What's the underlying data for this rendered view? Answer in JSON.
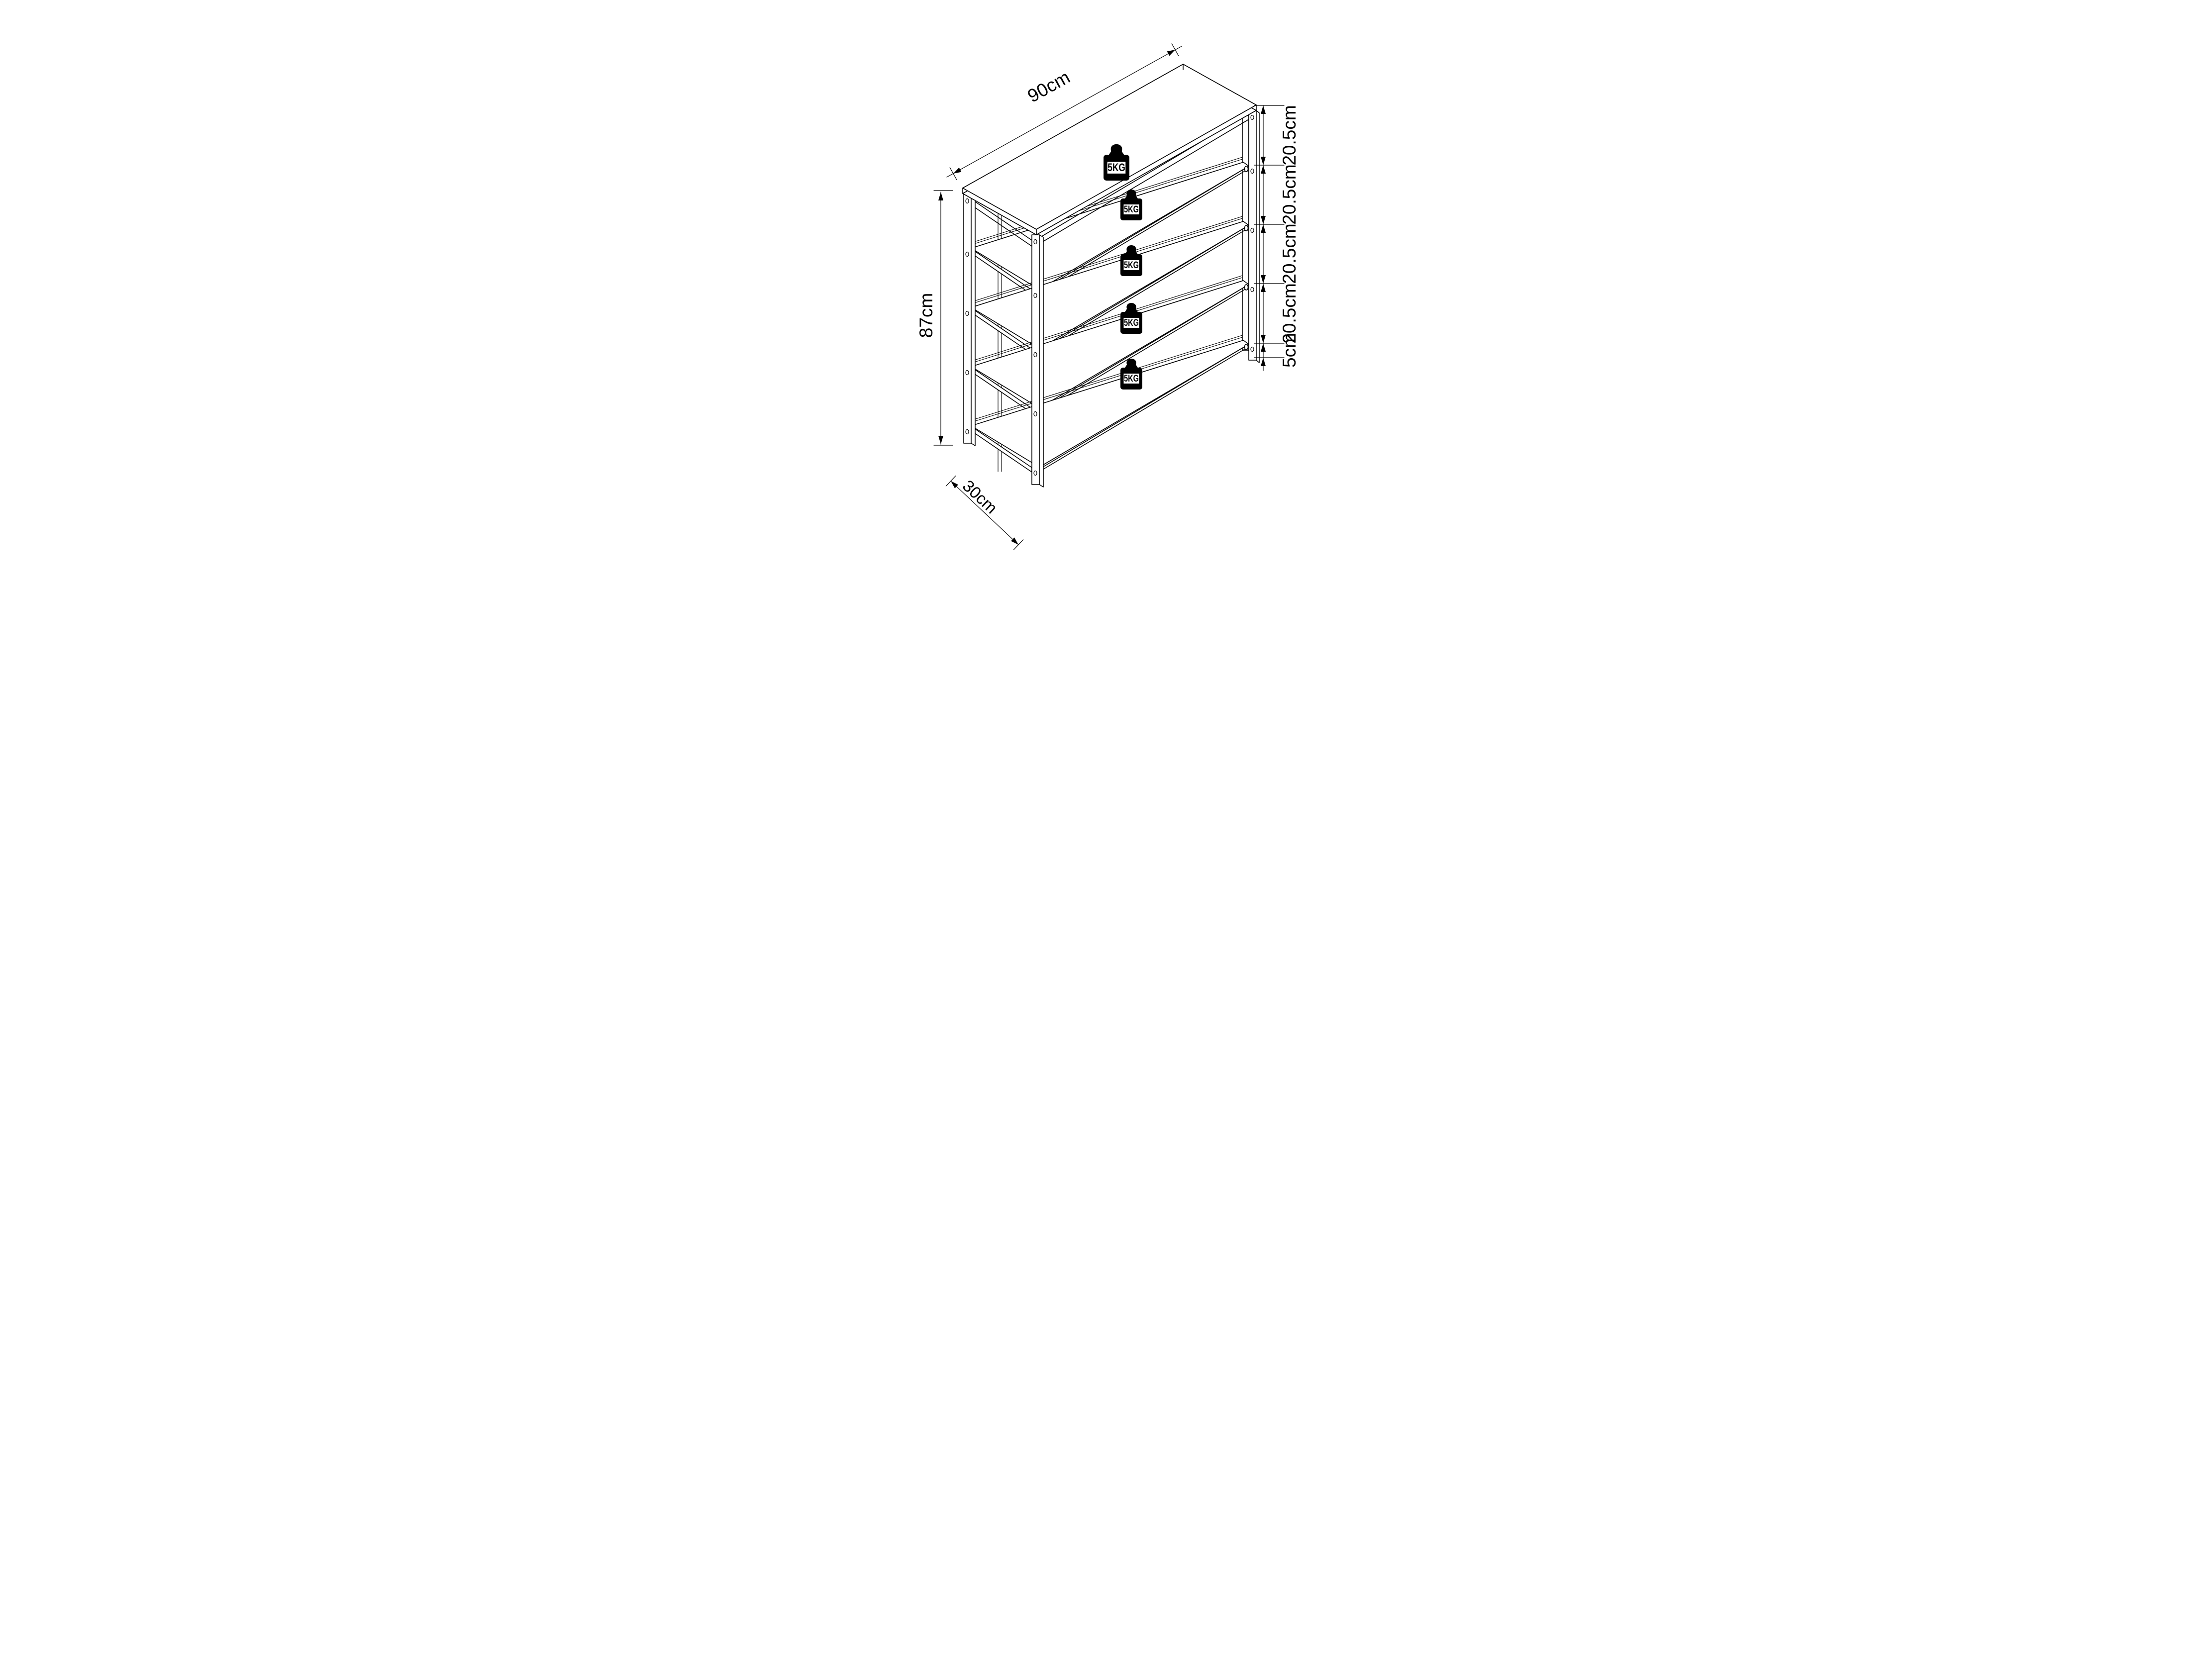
{
  "drawing": {
    "title_implicit": "shelf-unit-dimension-diagram",
    "line_color": "#000000",
    "background_color": "#ffffff",
    "dimensions": {
      "width_label": "90cm",
      "height_label": "87cm",
      "depth_label": "30cm",
      "spacings": [
        {
          "label": "20.5cm"
        },
        {
          "label": "20.5cm"
        },
        {
          "label": "20.5cm"
        },
        {
          "label": "20.5cm"
        },
        {
          "label": "5cm"
        }
      ]
    },
    "weights": [
      {
        "label": "5KG"
      },
      {
        "label": "5KG"
      },
      {
        "label": "5KG"
      },
      {
        "label": "5KG"
      },
      {
        "label": "5KG"
      }
    ]
  }
}
